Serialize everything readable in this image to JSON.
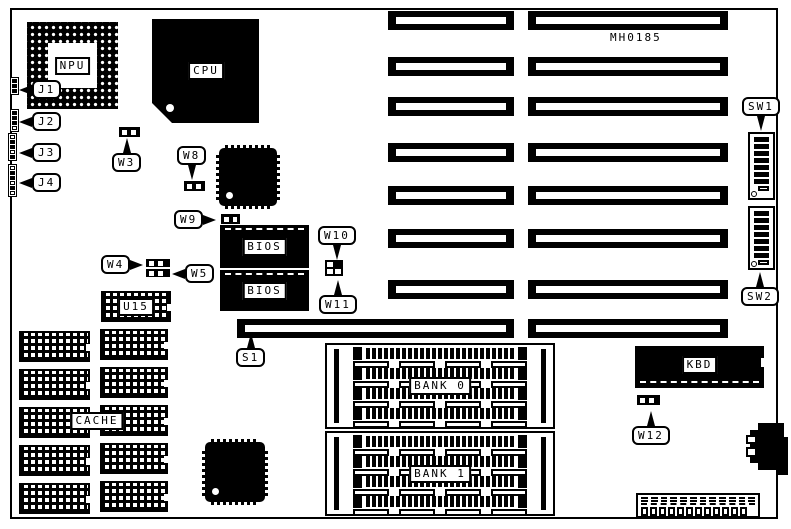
{
  "board": {
    "part_number": "MH0185"
  },
  "chip_labels": {
    "npu": "NPU",
    "cpu": "CPU",
    "bios_top": "BIOS",
    "bios_bottom": "BIOS",
    "u15": "U15",
    "cache": "CACHE",
    "bank0": "BANK 0",
    "bank1": "BANK 1",
    "kbd": "KBD"
  },
  "callouts": {
    "j1": "J1",
    "j2": "J2",
    "j3": "J3",
    "j4": "J4",
    "w3": "W3",
    "w4": "W4",
    "w5": "W5",
    "w8": "W8",
    "w9": "W9",
    "w10": "W10",
    "w11": "W11",
    "w12": "W12",
    "s1": "S1",
    "sw1": "SW1",
    "sw2": "SW2"
  },
  "counts": {
    "dip_switch_filled_positions": 7,
    "simm_sockets_per_bank": 4,
    "cache_chips_per_column": 5,
    "power_connector_pins": 12,
    "power_connector_pads": 12
  }
}
